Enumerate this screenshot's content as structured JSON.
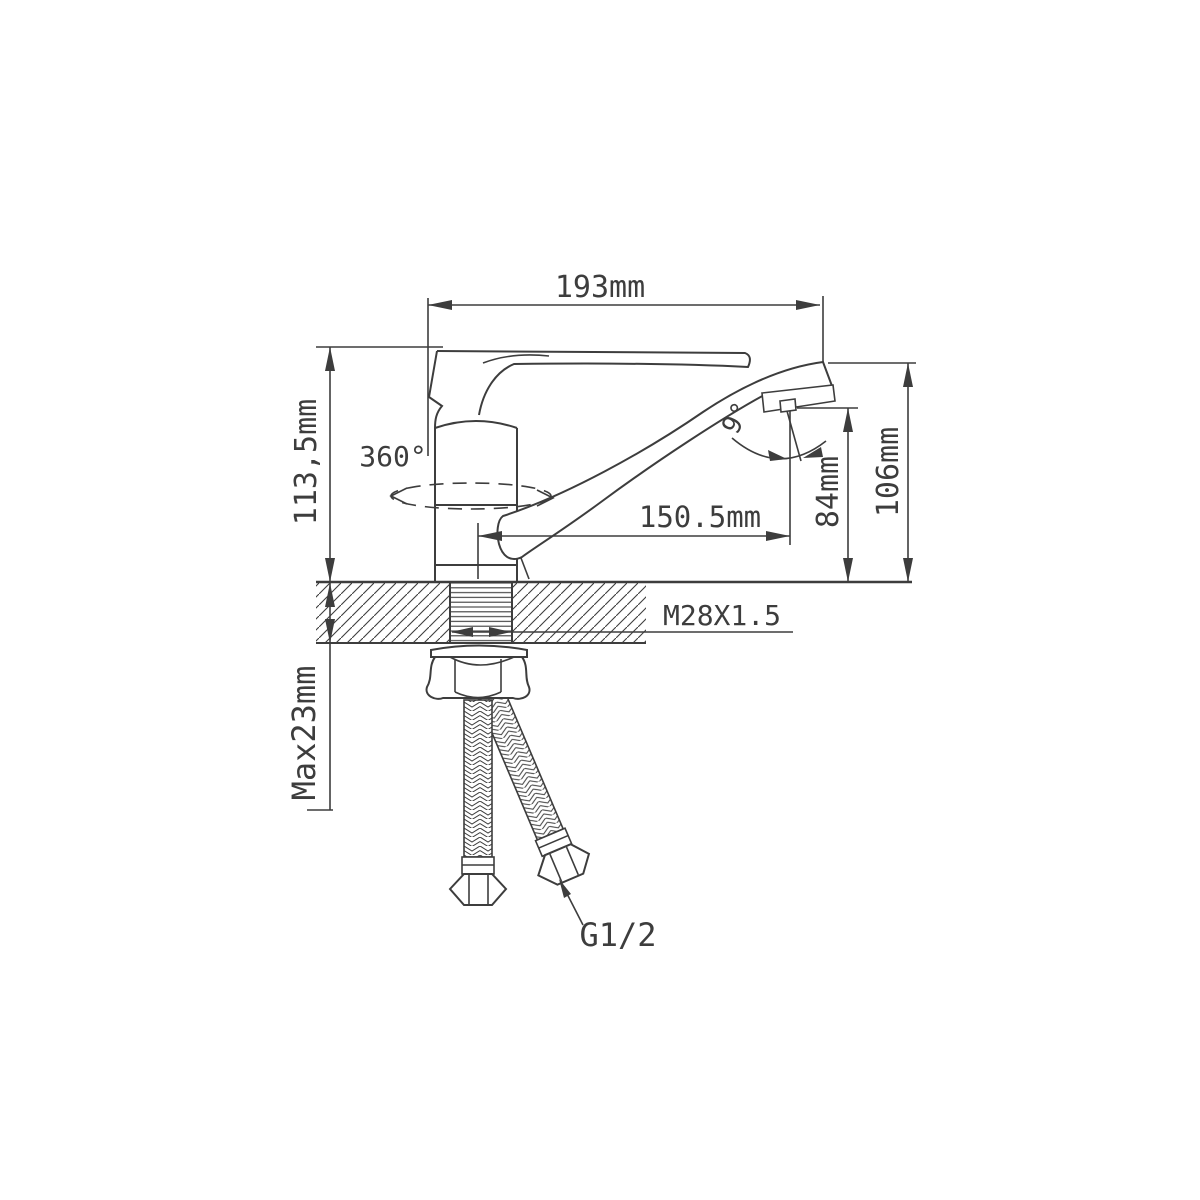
{
  "page": {
    "background_color": "#ffffff",
    "line_color": "#3d3d3d"
  },
  "drawing": {
    "type": "technical-drawing",
    "subject": "single-lever basin mixer faucet, side view with mounting shank and supply hoses",
    "labels": {
      "overall_width": "193mm",
      "body_height": "113,5mm",
      "swivel_angle": "360°",
      "spout_reach": "150.5mm",
      "spout_tilt": "9°",
      "aerator_height": "84mm",
      "spout_height": "106mm",
      "mounting_thread": "M28X1.5",
      "max_mount_thickness": "Max23mm",
      "hose_thread": "G1/2"
    }
  }
}
